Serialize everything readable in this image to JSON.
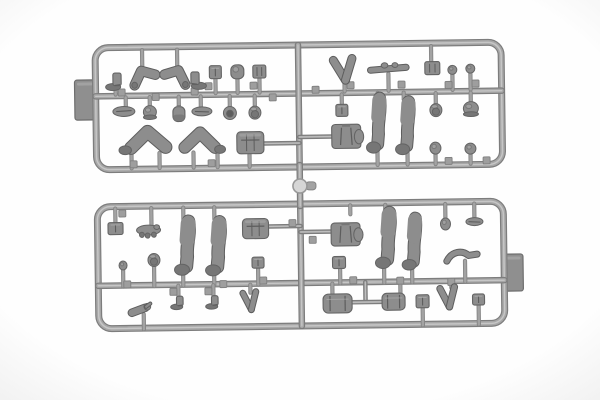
{
  "scene": {
    "subject": "gray plastic model-kit sprue with soldier figure parts (legs, arms, boots, heads, helmets, torsos, packs, pouches)",
    "canvas": {
      "w": 600,
      "h": 400
    },
    "tilt_deg": -0.8,
    "palette": {
      "bg_center": "#fefefe",
      "bg_edge": "#f1f1f1",
      "frame_edge": "#7d7d7d",
      "frame_core": "#a7a7a7",
      "frame_hi": "#c6c6c6",
      "stub_edge": "#858585",
      "stub_core": "#a3a3a3",
      "gate_fill": "#9e9e9e",
      "gate_edge": "#7f7f7f",
      "sidetab_fill": "#8f8f8f",
      "sidetab_edge": "#6d6d6d",
      "part_mid": "#8d8d8d",
      "part_dark": "#767676",
      "part_deep": "#5d5d5d",
      "part_edge": "#646464",
      "part_hi": "#b2b2b2",
      "knob_fill": "#d6d6d6",
      "knob_edge": "#989898"
    },
    "frames": [
      {
        "name": "top-frame",
        "x": 97,
        "y": 45,
        "w": 406,
        "h": 122,
        "rx": 13,
        "mid_runner_y": 93.5,
        "center_runner_x": 300
      },
      {
        "name": "bottom-frame",
        "x": 97,
        "y": 204,
        "w": 406,
        "h": 122,
        "rx": 13,
        "mid_runner_y": 283,
        "center_runner_x": 300
      }
    ],
    "side_tabs": [
      {
        "name": "left-mold-tab",
        "x": 76,
        "y": 77,
        "w": 22,
        "h": 40
      },
      {
        "name": "right-mold-tab",
        "x": 502,
        "y": 257,
        "w": 20,
        "h": 37
      }
    ],
    "connector": {
      "x": 300,
      "y1": 165,
      "y2": 206,
      "knob_cx": 300,
      "knob_cy": 186,
      "knob_r": 7,
      "nub_x": 306,
      "nub_y": 182,
      "nub_w": 10,
      "nub_h": 8
    },
    "runners": [
      [
        97,
        93.5,
        503,
        93.5,
        6.5
      ],
      [
        300,
        45,
        300,
        167,
        6.5
      ],
      [
        97,
        283,
        503,
        283,
        6.5
      ],
      [
        300,
        204,
        300,
        326,
        6.5
      ],
      [
        300,
        165,
        300,
        206,
        6.5
      ],
      [
        264,
        143,
        300,
        143,
        4.5
      ],
      [
        300,
        137,
        334,
        137,
        4.5
      ],
      [
        268,
        226,
        300,
        226,
        4.5
      ],
      [
        300,
        232,
        334,
        232,
        4.5
      ],
      [
        364,
        283,
        364,
        301,
        4.5
      ],
      [
        350,
        303,
        382,
        303,
        4.5
      ]
    ],
    "stubs": [
      [
        144,
        48,
        144,
        64
      ],
      [
        179,
        48,
        179,
        64
      ],
      [
        433,
        48,
        433,
        63
      ],
      [
        117,
        86,
        117,
        92
      ],
      [
        198,
        86,
        198,
        92
      ],
      [
        217,
        77,
        217,
        92
      ],
      [
        239,
        78,
        239,
        92
      ],
      [
        261,
        77,
        261,
        92
      ],
      [
        346,
        81,
        346,
        92
      ],
      [
        390,
        75,
        390,
        92
      ],
      [
        454,
        77,
        454,
        92
      ],
      [
        472,
        76,
        472,
        92
      ],
      [
        127,
        95,
        127,
        104
      ],
      [
        151,
        95,
        151,
        105
      ],
      [
        180,
        95,
        180,
        104
      ],
      [
        202,
        95,
        202,
        105
      ],
      [
        231,
        95,
        231,
        106
      ],
      [
        256,
        95,
        256,
        106
      ],
      [
        343,
        95,
        343,
        105
      ],
      [
        437,
        95,
        437,
        106
      ],
      [
        472,
        95,
        472,
        105
      ],
      [
        132,
        151,
        132,
        166
      ],
      [
        160,
        151,
        160,
        166
      ],
      [
        194,
        151,
        194,
        166
      ],
      [
        218,
        152,
        218,
        166
      ],
      [
        250,
        152,
        250,
        166
      ],
      [
        378,
        152,
        378,
        166
      ],
      [
        408,
        154,
        408,
        166
      ],
      [
        436,
        154,
        436,
        166
      ],
      [
        471,
        155,
        471,
        166
      ],
      [
        379,
        94,
        379,
        100
      ],
      [
        405,
        94,
        405,
        101
      ],
      [
        115,
        206,
        115,
        221
      ],
      [
        151,
        206,
        151,
        224
      ],
      [
        183,
        206,
        183,
        219
      ],
      [
        214,
        206,
        214,
        218
      ],
      [
        350,
        206,
        350,
        215
      ],
      [
        385,
        206,
        385,
        213
      ],
      [
        445,
        206,
        445,
        221
      ],
      [
        474,
        206,
        474,
        220
      ],
      [
        182,
        271,
        182,
        284
      ],
      [
        213,
        272,
        213,
        284
      ],
      [
        383,
        267,
        383,
        284
      ],
      [
        411,
        269,
        411,
        284
      ],
      [
        122,
        266,
        122,
        284
      ],
      [
        153,
        263,
        153,
        284
      ],
      [
        257,
        266,
        257,
        284
      ],
      [
        339,
        268,
        339,
        284
      ],
      [
        142,
        312,
        142,
        327
      ],
      [
        177,
        284,
        177,
        295
      ],
      [
        212,
        284,
        212,
        295
      ],
      [
        249,
        284,
        249,
        292
      ],
      [
        331,
        284,
        331,
        296
      ],
      [
        399,
        284,
        399,
        295
      ],
      [
        421,
        308,
        421,
        327
      ],
      [
        450,
        284,
        450,
        290
      ],
      [
        477,
        307,
        477,
        327
      ],
      [
        464,
        263,
        464,
        284
      ]
    ],
    "gate_tabs": [
      [
        123,
        90
      ],
      [
        157,
        95
      ],
      [
        196,
        90
      ],
      [
        210,
        85
      ],
      [
        255,
        85
      ],
      [
        274,
        97
      ],
      [
        317,
        90
      ],
      [
        352,
        86
      ],
      [
        403,
        86
      ],
      [
        450,
        87
      ],
      [
        477,
        86
      ],
      [
        134,
        162
      ],
      [
        212,
        162
      ],
      [
        449,
        163
      ],
      [
        487,
        163
      ],
      [
        122,
        211
      ],
      [
        292,
        223
      ],
      [
        312,
        240
      ],
      [
        352,
        281
      ],
      [
        399,
        282
      ],
      [
        126,
        282
      ],
      [
        222,
        283
      ],
      [
        262,
        280
      ],
      [
        172,
        290
      ],
      [
        207,
        290
      ],
      [
        450,
        284
      ]
    ],
    "parts": [
      {
        "n": "boot",
        "t": "boot",
        "x": 117,
        "y": 79,
        "w": 15,
        "h": 17,
        "d": -1
      },
      {
        "n": "bent-arm",
        "t": "arm",
        "x": 146,
        "y": 75,
        "w": 26,
        "h": 19,
        "d": -1
      },
      {
        "n": "bent-arm",
        "t": "arm",
        "x": 177,
        "y": 75,
        "w": 26,
        "h": 19,
        "d": 1
      },
      {
        "n": "boot",
        "t": "boot",
        "x": 198,
        "y": 79,
        "w": 15,
        "h": 17,
        "d": 1
      },
      {
        "n": "pouch",
        "t": "pouch",
        "x": 217,
        "y": 71,
        "w": 12,
        "h": 13,
        "d": 1
      },
      {
        "n": "round-pouch",
        "t": "pouch-round",
        "x": 239,
        "y": 71,
        "w": 13,
        "h": 14,
        "d": 1
      },
      {
        "n": "gridded-pouch",
        "t": "pouch-grid",
        "x": 261,
        "y": 71,
        "w": 13,
        "h": 13,
        "d": 1
      },
      {
        "n": "paired-arms",
        "t": "arms-v",
        "x": 346,
        "y": 70,
        "w": 26,
        "h": 24,
        "d": 1
      },
      {
        "n": "arm-pair-horizontal",
        "t": "arms-horiz",
        "x": 390,
        "y": 70,
        "w": 37,
        "h": 12,
        "d": 1
      },
      {
        "n": "gridded-pouch",
        "t": "pouch-grid",
        "x": 434,
        "y": 70,
        "w": 15,
        "h": 13,
        "d": 1
      },
      {
        "n": "head-ball",
        "t": "ball",
        "x": 454,
        "y": 72,
        "w": 9,
        "h": 9,
        "d": 1
      },
      {
        "n": "head-ball",
        "t": "ball",
        "x": 472,
        "y": 71,
        "w": 9,
        "h": 9,
        "d": 1
      },
      {
        "n": "field-cap",
        "t": "cap",
        "x": 125,
        "y": 109,
        "w": 22,
        "h": 10,
        "d": -1
      },
      {
        "n": "helmet",
        "t": "helmet",
        "x": 151,
        "y": 111,
        "w": 13,
        "h": 14,
        "d": 1
      },
      {
        "n": "canteen",
        "t": "canteen",
        "x": 180,
        "y": 112,
        "w": 12,
        "h": 17,
        "d": 1
      },
      {
        "n": "field-cap",
        "t": "cap",
        "x": 203,
        "y": 110,
        "w": 20,
        "h": 9,
        "d": 1
      },
      {
        "n": "helmet-top",
        "t": "helmet-ring",
        "x": 231,
        "y": 112,
        "w": 13,
        "h": 13,
        "d": 1
      },
      {
        "n": "head",
        "t": "head",
        "x": 256,
        "y": 112,
        "w": 12,
        "h": 13,
        "d": 1
      },
      {
        "n": "pouch",
        "t": "pouch",
        "x": 343,
        "y": 111,
        "w": 12,
        "h": 12,
        "d": 1
      },
      {
        "n": "head",
        "t": "head",
        "x": 437,
        "y": 112,
        "w": 12,
        "h": 13,
        "d": 1
      },
      {
        "n": "helmet",
        "t": "helmet",
        "x": 472,
        "y": 112,
        "w": 15,
        "h": 15,
        "d": 1
      },
      {
        "n": "bent-leg",
        "t": "leg-bent",
        "x": 146,
        "y": 140,
        "w": 48,
        "h": 26,
        "d": -1
      },
      {
        "n": "bent-leg",
        "t": "leg-bent",
        "x": 203,
        "y": 141,
        "w": 42,
        "h": 24,
        "d": 1
      },
      {
        "n": "torso-with-pack",
        "t": "torso-pack",
        "x": 251,
        "y": 142,
        "w": 27,
        "h": 22,
        "d": 1
      },
      {
        "n": "torso",
        "t": "torso",
        "x": 347,
        "y": 137,
        "w": 29,
        "h": 24,
        "d": 1
      },
      {
        "n": "straight-leg",
        "t": "leg-straight",
        "x": 378,
        "y": 125,
        "w": 16,
        "h": 56,
        "d": -1
      },
      {
        "n": "straight-leg",
        "t": "leg-straight",
        "x": 407,
        "y": 128,
        "w": 16,
        "h": 54,
        "d": -1
      },
      {
        "n": "head-ball",
        "t": "ball",
        "x": 436,
        "y": 150,
        "w": 11,
        "h": 12,
        "d": 1
      },
      {
        "n": "head-ball",
        "t": "ball",
        "x": 471,
        "y": 151,
        "w": 11,
        "h": 11,
        "d": 1
      },
      {
        "n": "pouch",
        "t": "pouch",
        "x": 115,
        "y": 226,
        "w": 15,
        "h": 12,
        "d": 1
      },
      {
        "n": "equipment-cluster",
        "t": "gear",
        "x": 148,
        "y": 229,
        "w": 24,
        "h": 13,
        "d": 1
      },
      {
        "n": "straight-leg",
        "t": "leg-straight",
        "x": 185,
        "y": 245,
        "w": 17,
        "h": 55,
        "d": -1
      },
      {
        "n": "straight-leg",
        "t": "leg-straight",
        "x": 216,
        "y": 246,
        "w": 17,
        "h": 55,
        "d": -1
      },
      {
        "n": "torso-with-pack",
        "t": "torso-pack",
        "x": 255,
        "y": 228,
        "w": 26,
        "h": 20,
        "d": 1
      },
      {
        "n": "head-ball",
        "t": "ball",
        "x": 122,
        "y": 263,
        "w": 8,
        "h": 9,
        "d": 1
      },
      {
        "n": "head",
        "t": "head",
        "x": 153,
        "y": 258,
        "w": 12,
        "h": 13,
        "d": 1
      },
      {
        "n": "pouch",
        "t": "pouch",
        "x": 257,
        "y": 262,
        "w": 12,
        "h": 11,
        "d": 1
      },
      {
        "n": "hand-arm",
        "t": "hand",
        "x": 139,
        "y": 307,
        "w": 21,
        "h": 12,
        "d": 1
      },
      {
        "n": "boot",
        "t": "boot",
        "x": 177,
        "y": 301,
        "w": 12,
        "h": 13,
        "d": -1
      },
      {
        "n": "boot",
        "t": "boot",
        "x": 212,
        "y": 301,
        "w": 12,
        "h": 13,
        "d": -1
      },
      {
        "n": "paired-arms",
        "t": "arms-v",
        "x": 249,
        "y": 300,
        "w": 18,
        "h": 20,
        "d": 1
      },
      {
        "n": "torso",
        "t": "torso",
        "x": 345,
        "y": 235,
        "w": 29,
        "h": 23,
        "d": 1
      },
      {
        "n": "pouch",
        "t": "pouch",
        "x": 338,
        "y": 263,
        "w": 13,
        "h": 12,
        "d": 1
      },
      {
        "n": "straight-leg",
        "t": "leg-straight",
        "x": 386,
        "y": 240,
        "w": 17,
        "h": 57,
        "d": -1
      },
      {
        "n": "straight-leg",
        "t": "leg-straight",
        "x": 412,
        "y": 244,
        "w": 16,
        "h": 53,
        "d": -1
      },
      {
        "n": "head-ball",
        "t": "ball",
        "x": 445,
        "y": 226,
        "w": 10,
        "h": 12,
        "d": 1
      },
      {
        "n": "field-cap",
        "t": "cap",
        "x": 474,
        "y": 224,
        "w": 17,
        "h": 8,
        "d": 1
      },
      {
        "n": "curved-arm",
        "t": "curved-arm",
        "x": 461,
        "y": 259,
        "w": 33,
        "h": 12,
        "d": 1
      },
      {
        "n": "bedroll-pack",
        "t": "pack",
        "x": 336,
        "y": 304,
        "w": 29,
        "h": 19,
        "d": 1
      },
      {
        "n": "small-pack",
        "t": "pack",
        "x": 392,
        "y": 303,
        "w": 23,
        "h": 17,
        "d": 1
      },
      {
        "n": "pouch",
        "t": "pouch",
        "x": 421,
        "y": 303,
        "w": 13,
        "h": 13,
        "d": 1
      },
      {
        "n": "paired-arms",
        "t": "arms-v",
        "x": 447,
        "y": 299,
        "w": 20,
        "h": 22,
        "d": 1
      },
      {
        "n": "pouch",
        "t": "pouch",
        "x": 477,
        "y": 302,
        "w": 12,
        "h": 11,
        "d": 1
      }
    ]
  }
}
